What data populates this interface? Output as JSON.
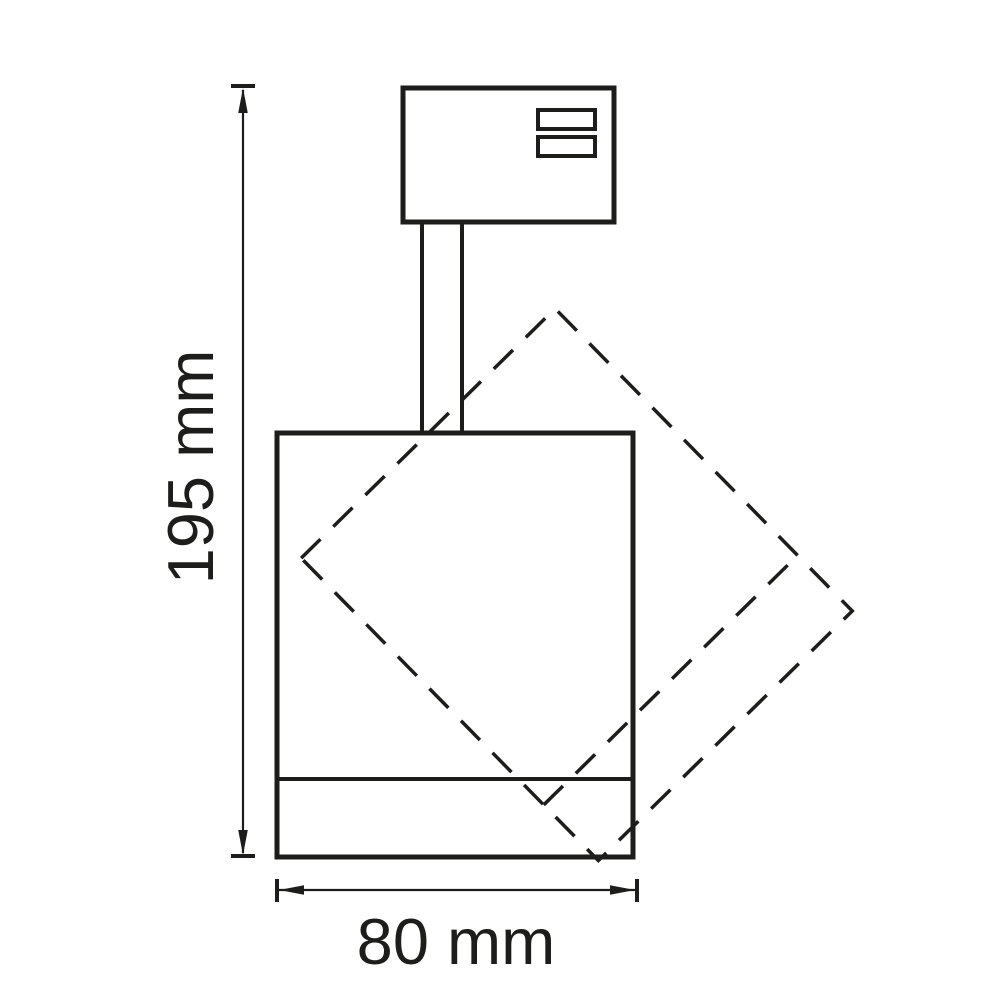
{
  "document": {
    "type": "technical-dimension-drawing",
    "subject": "track spotlight side view with dashed 45-degree rotated body outline"
  },
  "dimensions": {
    "height": {
      "label": "195 mm",
      "value": 195,
      "unit": "mm"
    },
    "width": {
      "label": "80 mm",
      "value": 80,
      "unit": "mm"
    }
  },
  "parts": {
    "track_adapter": "track-adapter-box",
    "contact_slots": "two contact slots in adapter top-right",
    "stem": "mounting-stem",
    "body": "cylindrical-lamp-body",
    "trim_line": "front-trim-ring-line",
    "rotation_outline": "dashed-rotated-body-outline"
  },
  "colors": {
    "line": "#1d1d1b",
    "background": "#ffffff"
  }
}
